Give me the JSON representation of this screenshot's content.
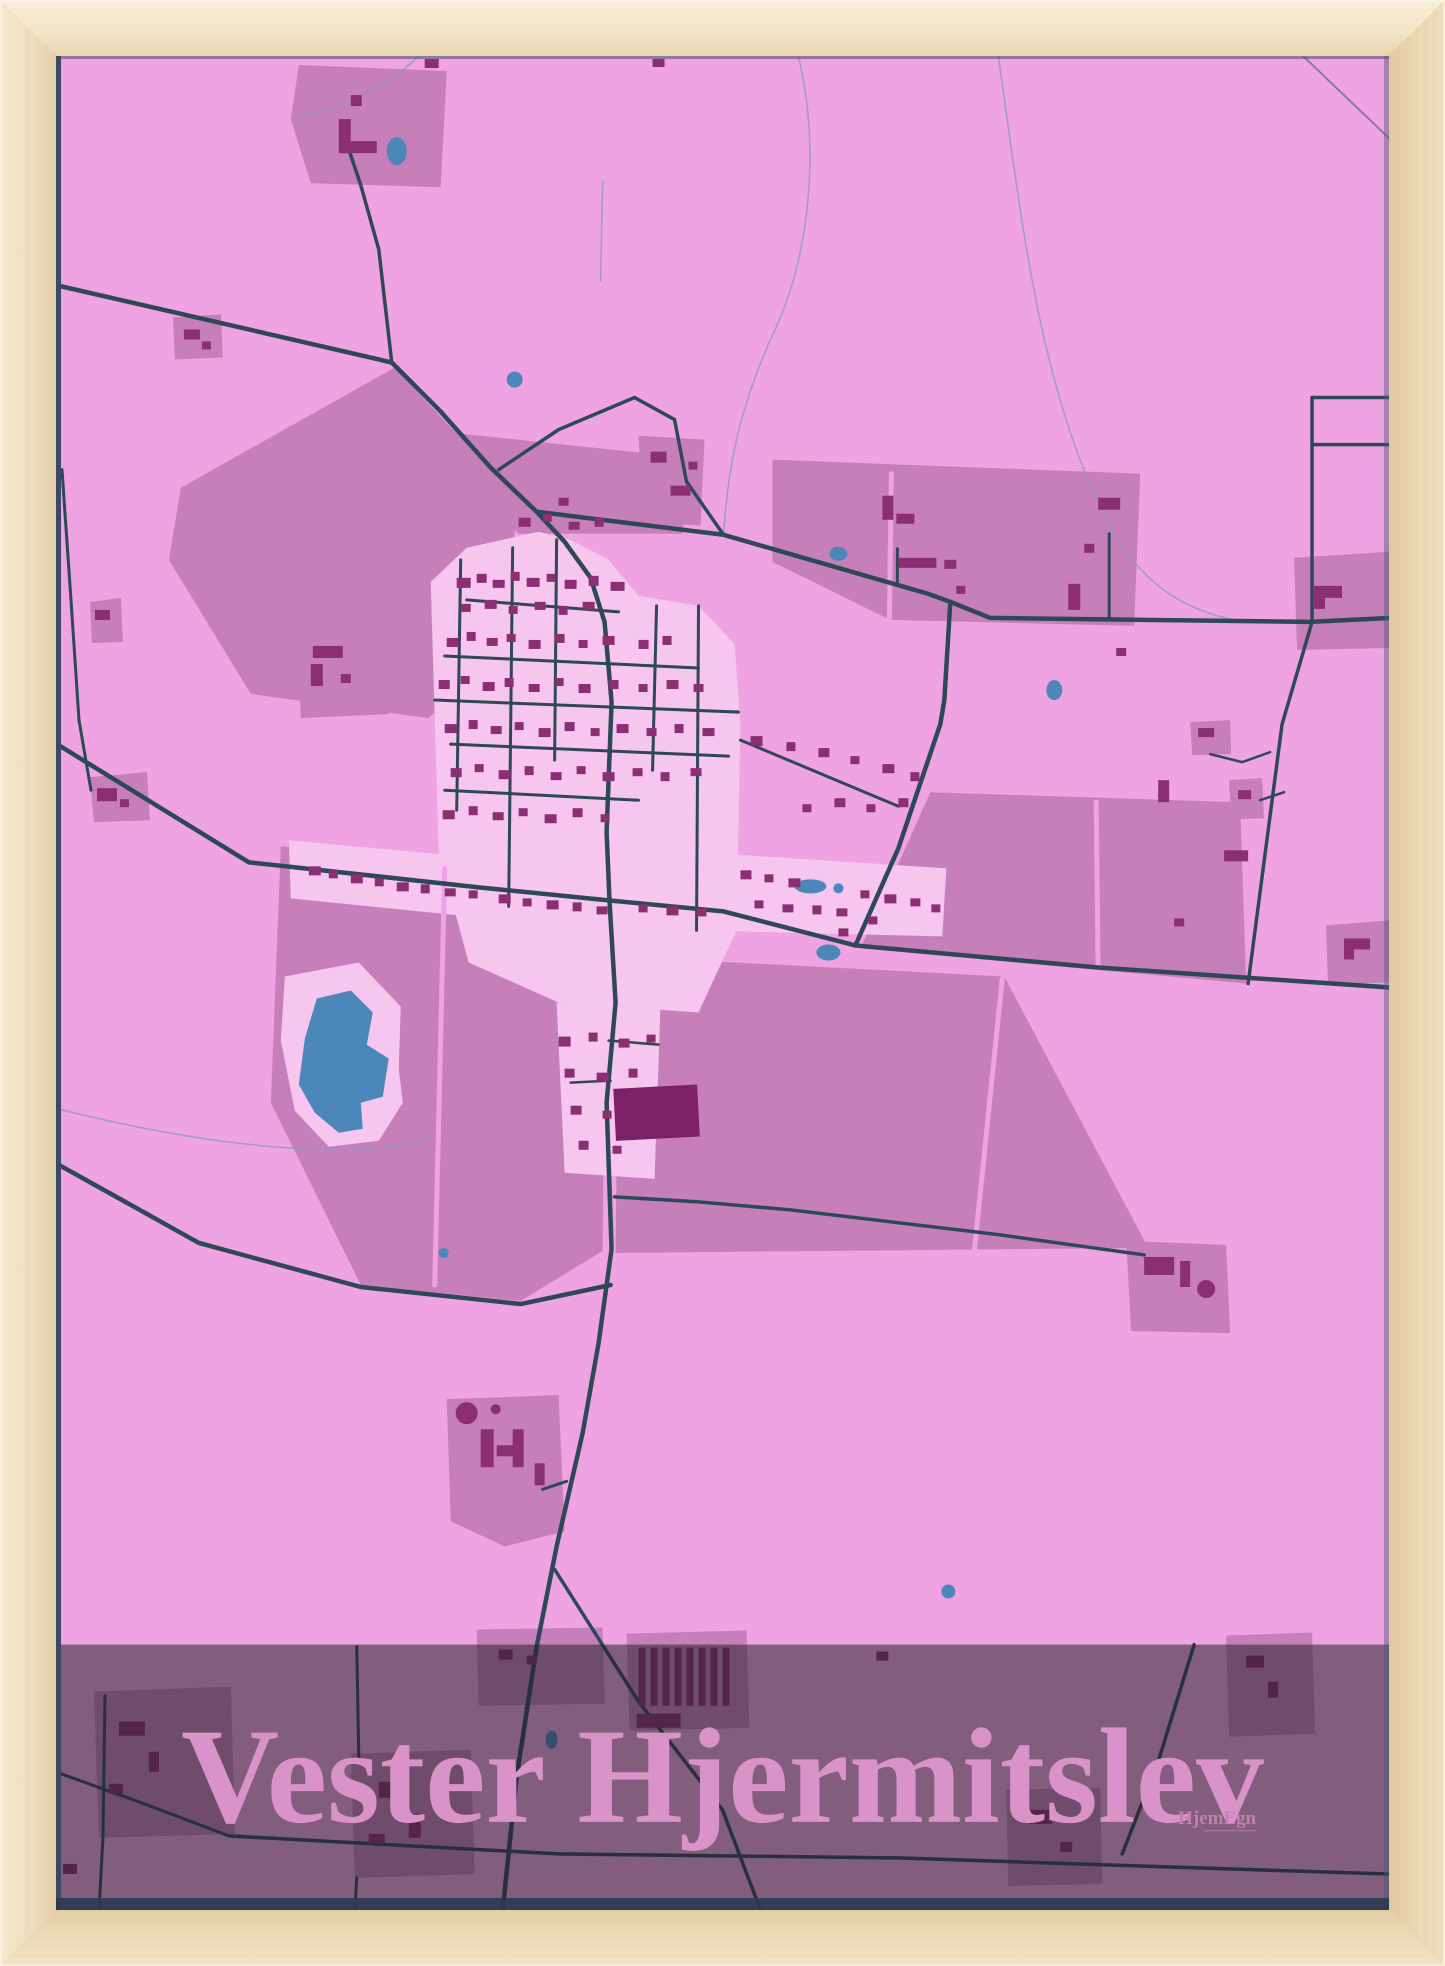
{
  "poster": {
    "title": "Vester Hjermitslev",
    "brand": "HjemEgn"
  },
  "palette": {
    "background_pink": "#efa3e2",
    "field_mauve": "#c77fba",
    "residential_pink": "#f6c6ee",
    "building_purple": "#8b2e74",
    "building_dark": "#7c2068",
    "road_dark": "#2f4858",
    "road_light": "#8a9ab5",
    "water_blue": "#4c87b9",
    "band_overlay": "rgba(30,28,34,0.52)",
    "title_pink": "#d993c9",
    "brand_pink": "#c47fb2",
    "frame_wood": "#f0e0c0"
  }
}
